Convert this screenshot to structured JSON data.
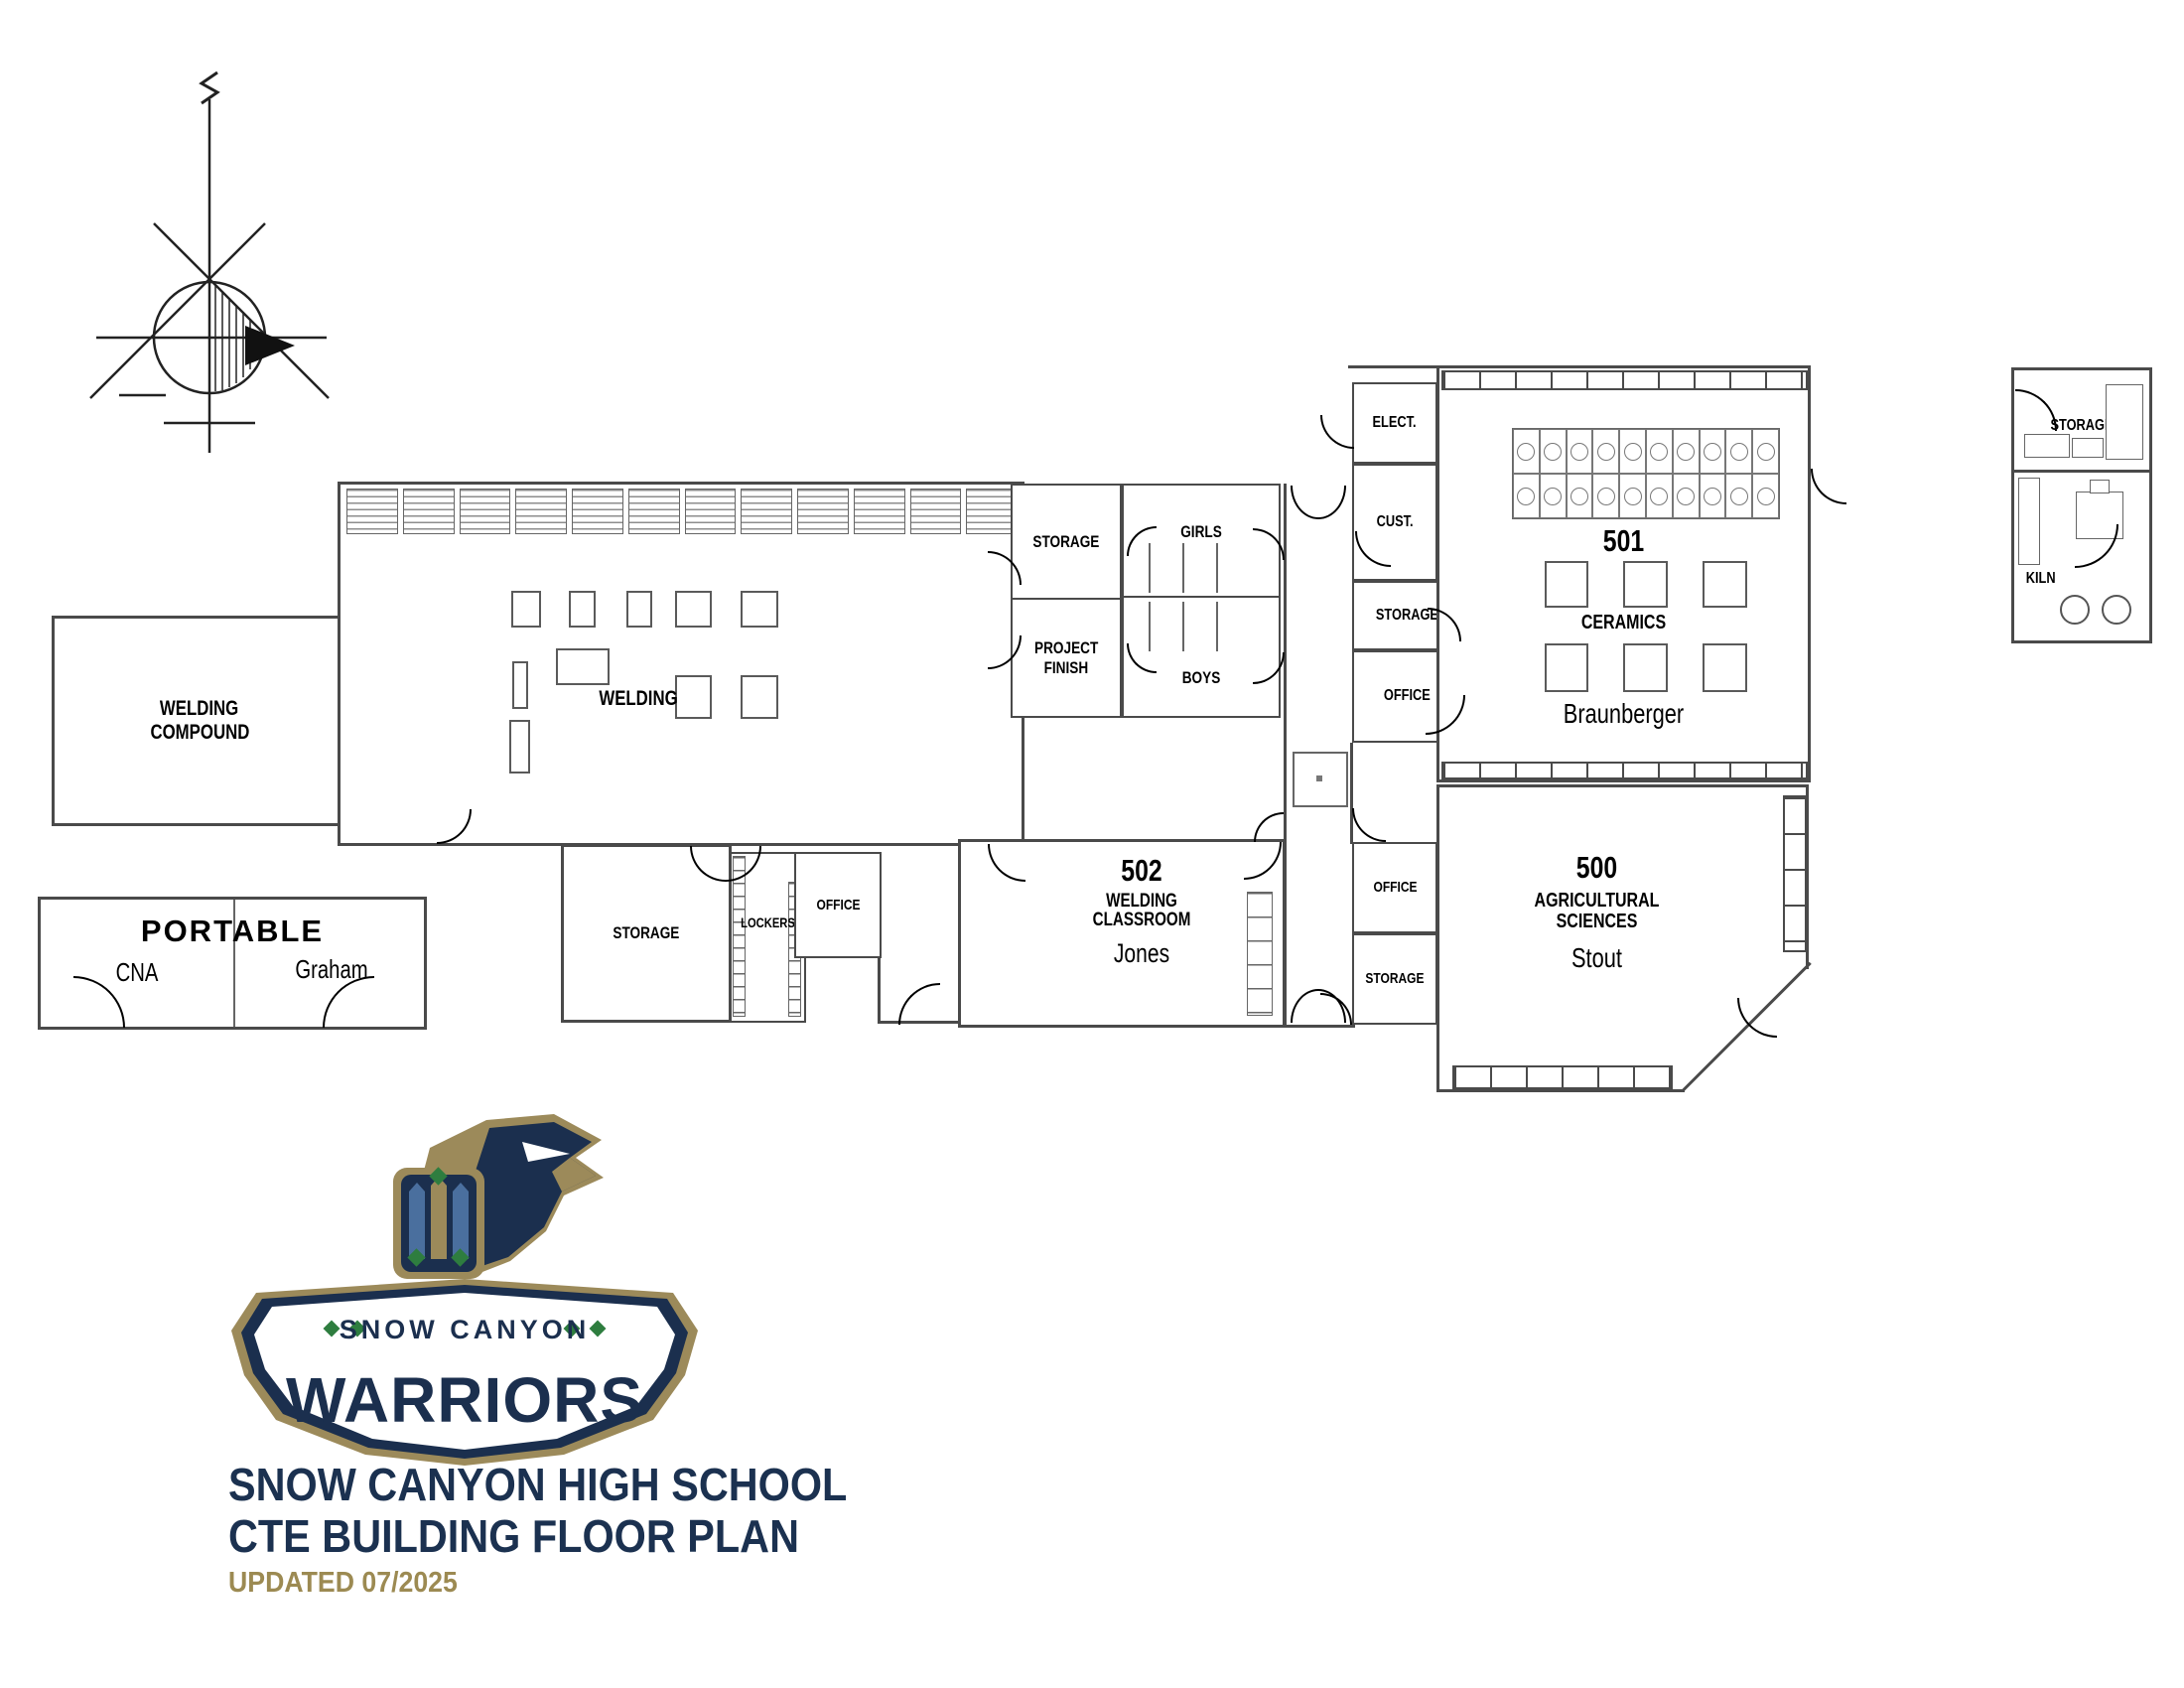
{
  "colors": {
    "navy": "#1b2f4e",
    "gold": "#9c8a5a",
    "green": "#2e7d3f",
    "steel_blue": "#4a6f9e",
    "wall_gray": "#4a4a4a",
    "label_black": "#000000"
  },
  "plan": {
    "welding_compound_line1": "WELDING",
    "welding_compound_line2": "COMPOUND",
    "welding_shop": "WELDING",
    "storage_nw": "STORAGE",
    "project_finish_line1": "PROJECT",
    "project_finish_line2": "FINISH",
    "girls": "GIRLS",
    "boys": "BOYS",
    "storage_sw": "STORAGE",
    "lockers": "LOCKERS",
    "office_sw": "OFFICE",
    "room502_number": "502",
    "room502_line1": "WELDING",
    "room502_line2": "CLASSROOM",
    "room502_teacher": "Jones",
    "elect": "ELECT.",
    "cust": "CUST.",
    "storage_ceramics": "STORAGE",
    "office_ceramics": "OFFICE",
    "room501_number": "501",
    "room501_name": "CERAMICS",
    "room501_teacher": "Braunberger",
    "office_ag": "OFFICE",
    "storage_ag": "STORAGE",
    "room500_number": "500",
    "room500_line1": "AGRICULTURAL",
    "room500_line2": "SCIENCES",
    "room500_teacher": "Stout",
    "portable_title": "PORTABLE",
    "portable_left": "CNA",
    "portable_right": "Graham",
    "kiln_storage": "STORAGE",
    "kiln": "KILN"
  },
  "branding": {
    "banner_top": "SNOW CANYON",
    "banner_main": "WARRIORS",
    "school_name": "SNOW CANYON HIGH SCHOOL",
    "plan_title": "CTE BUILDING FLOOR PLAN",
    "updated": "UPDATED 07/2025"
  }
}
